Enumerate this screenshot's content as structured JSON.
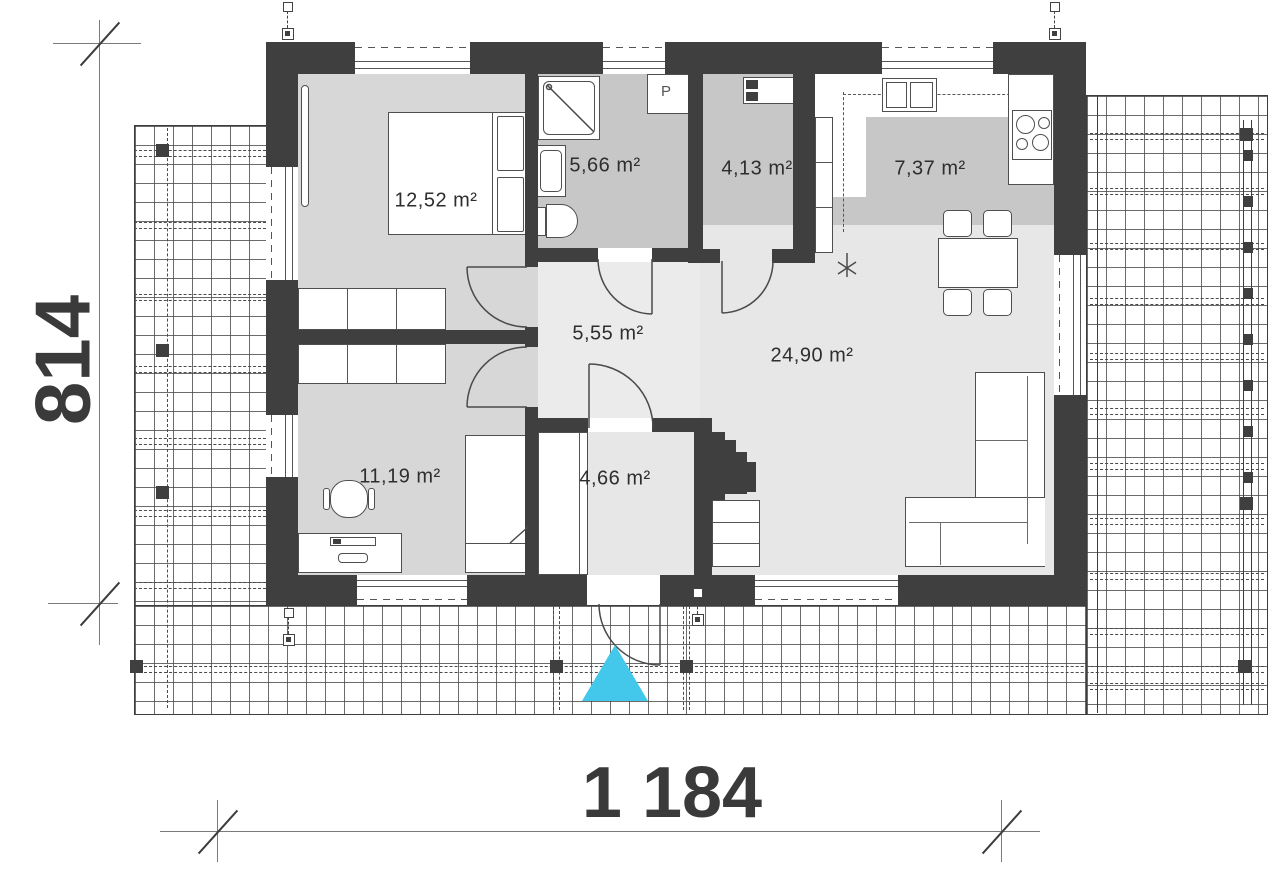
{
  "dimensions": {
    "width_label": "1 184",
    "height_label": "814"
  },
  "rooms": [
    {
      "id": "bedroom",
      "area": "12,52 m²"
    },
    {
      "id": "bathroom",
      "area": "5,66 m²"
    },
    {
      "id": "storage",
      "area": "4,13 m²"
    },
    {
      "id": "kitchen",
      "area": "7,37 m²"
    },
    {
      "id": "hall",
      "area": "5,55 m²"
    },
    {
      "id": "living-room",
      "area": "24,90 m²"
    },
    {
      "id": "office",
      "area": "11,19 m²"
    },
    {
      "id": "vestibule",
      "area": "4,66 m²"
    }
  ],
  "appliances": {
    "washer_label": "P"
  },
  "colors": {
    "wall": "#3f3f3f",
    "floor_light": "#e7e7e7",
    "floor_medium": "#d7d7d7",
    "floor_dark": "#c7c7c7",
    "entrance_marker": "#43c7ea",
    "dimension_text": "#3a3a3a"
  }
}
